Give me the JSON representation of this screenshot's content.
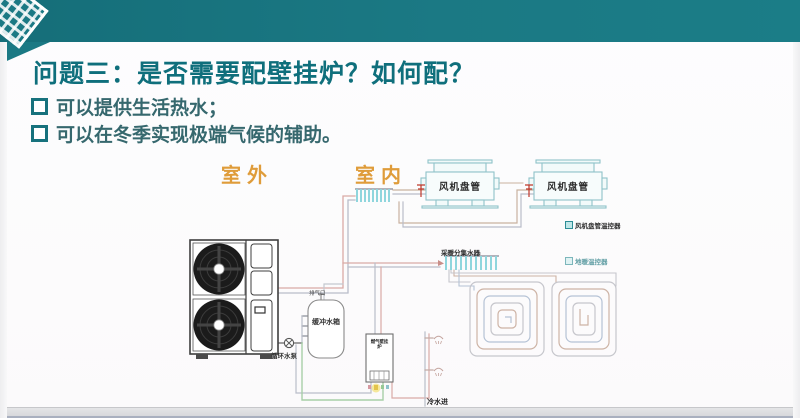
{
  "slide": {
    "title": "问题三：是否需要配壁挂炉？如何配？",
    "bullets": [
      {
        "text": "可以提供生活热水；"
      },
      {
        "text": "可以在冬季实现极端气候的辅助。"
      }
    ],
    "zones": {
      "outdoor": "室外",
      "indoor": "室内"
    }
  },
  "diagram": {
    "fan_coils": [
      {
        "label": "风机盘管"
      },
      {
        "label": "风机盘管"
      }
    ],
    "thermostats": [
      {
        "label": "风机盘管温控器"
      },
      {
        "label": "地暖温控器"
      }
    ],
    "heating_manifold_label": "采暖分集水器",
    "buffer_tank_label": "缓冲水箱",
    "air_vent_label": "排气口",
    "circulation_pump_label": "循环水泵",
    "boiler_label": "燃气壁挂炉",
    "cold_water_inlet_label": "冷水进"
  },
  "colors": {
    "teal_bar": "#1b7984",
    "title_text": "#0f6f7c",
    "body_text": "#36686e",
    "zone_label": "#df9c3a",
    "pipe_hot": "#d9aaa6",
    "pipe_return": "#b9bdc9",
    "pipe_green": "#a8cfa8",
    "manifold_cyan": "#8fd6dd",
    "valve_red": "#c0392b",
    "floor_bar": "#d6d7da"
  }
}
